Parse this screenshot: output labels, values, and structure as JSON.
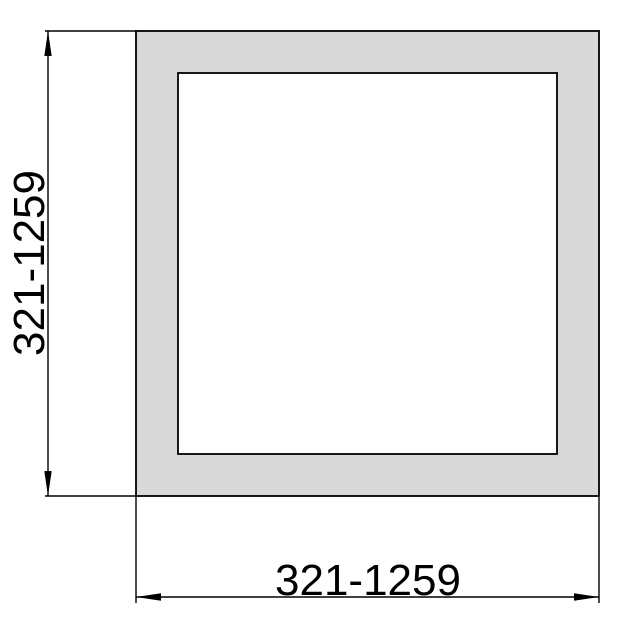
{
  "drawing": {
    "profile": {
      "outer_fill": "#d9d9d9",
      "inner_fill": "#ffffff",
      "line_color": "#000000"
    },
    "dimensions": {
      "height": {
        "label": "321-1259"
      },
      "width": {
        "label": "321-1259"
      }
    }
  }
}
